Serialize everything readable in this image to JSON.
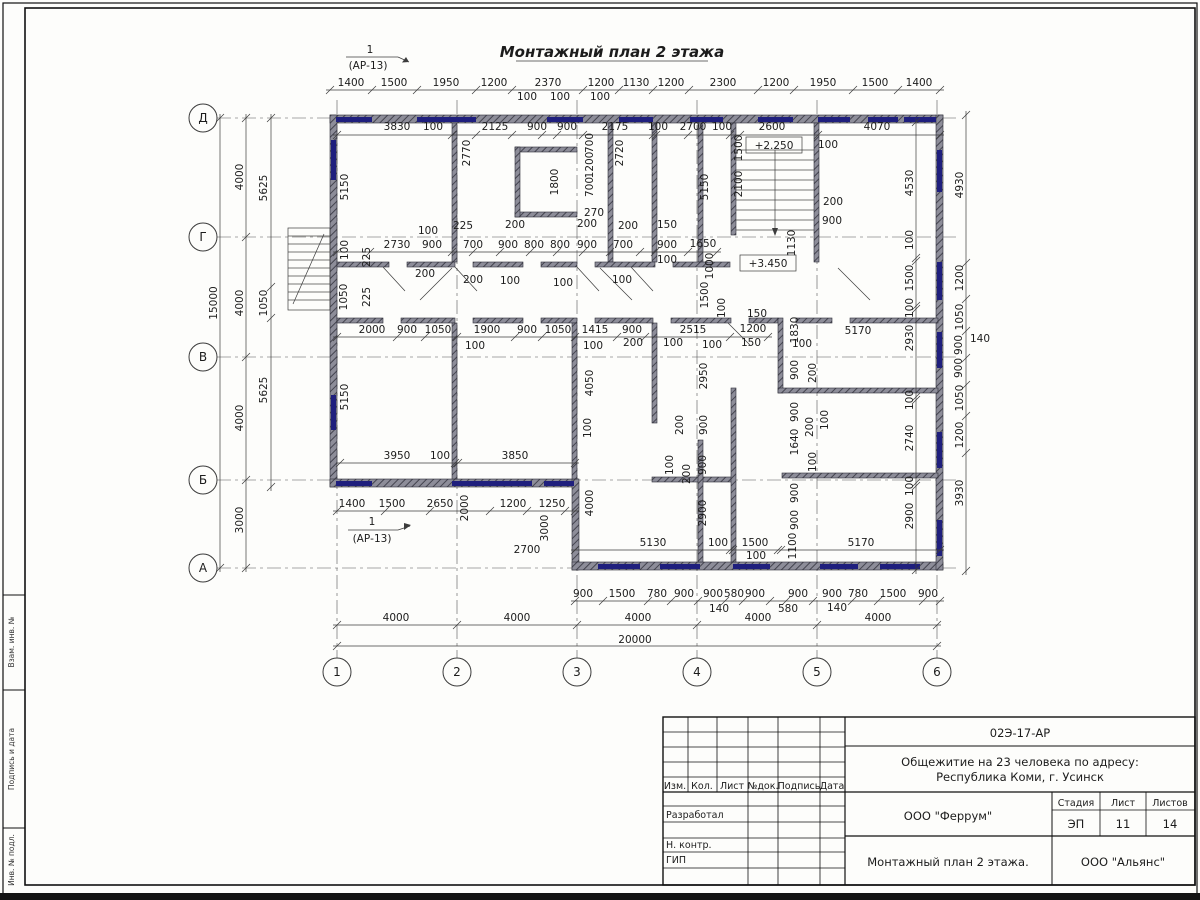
{
  "drawing": {
    "title": "Монтажный план 2 этажа",
    "section_mark": {
      "number": "1",
      "sheet_ref": "(АР-13)"
    },
    "elevation_marks": [
      "+2.250",
      "+3.450"
    ]
  },
  "axes": {
    "rows": [
      "Д",
      "Г",
      "В",
      "Б",
      "А"
    ],
    "cols": [
      "1",
      "2",
      "3",
      "4",
      "5",
      "6"
    ]
  },
  "frame_labels": [
    "Взам. инв. №",
    "Подпись и дата",
    "Инв. № подл."
  ],
  "title_block": {
    "doc_number": "02Э-17-АР",
    "project_line1": "Общежитие на 23 человека по адресу:",
    "project_line2": "Республика Коми, г. Усинск",
    "rev_columns": [
      "Изм.",
      "Кол.",
      "Лист",
      "№док.",
      "Подпись",
      "Дата"
    ],
    "role_rows": [
      "Разработал",
      "Н. контр.",
      "ГИП"
    ],
    "designer": "ООО \"Феррум\"",
    "stage_label": "Стадия",
    "stage": "ЭП",
    "sheet_label": "Лист",
    "sheet": "11",
    "sheets_label": "Листов",
    "sheets": "14",
    "drawing_title": "Монтажный план 2 этажа.",
    "contractor": "ООО \"Альянс\""
  },
  "colors": {
    "wall": "#8d8d99",
    "window": "#1f1f7d",
    "line": "#3c3c3c",
    "text": "#1c1c1c"
  },
  "annotations": [
    {
      "t": "1400",
      "x": 351,
      "y": 86
    },
    {
      "t": "1500",
      "x": 394,
      "y": 86
    },
    {
      "t": "1950",
      "x": 446,
      "y": 86
    },
    {
      "t": "1200",
      "x": 494,
      "y": 86
    },
    {
      "t": "2370",
      "x": 548,
      "y": 86
    },
    {
      "t": "1200",
      "x": 601,
      "y": 86
    },
    {
      "t": "1130",
      "x": 636,
      "y": 86
    },
    {
      "t": "1200",
      "x": 671,
      "y": 86
    },
    {
      "t": "2300",
      "x": 723,
      "y": 86
    },
    {
      "t": "1200",
      "x": 776,
      "y": 86
    },
    {
      "t": "1950",
      "x": 823,
      "y": 86
    },
    {
      "t": "1500",
      "x": 875,
      "y": 86
    },
    {
      "t": "1400",
      "x": 919,
      "y": 86
    },
    {
      "t": "100",
      "x": 527,
      "y": 100
    },
    {
      "t": "100",
      "x": 560,
      "y": 100
    },
    {
      "t": "100",
      "x": 600,
      "y": 100
    },
    {
      "t": "3830",
      "x": 397,
      "y": 130
    },
    {
      "t": "100",
      "x": 433,
      "y": 130
    },
    {
      "t": "2125",
      "x": 495,
      "y": 130
    },
    {
      "t": "900",
      "x": 537,
      "y": 130
    },
    {
      "t": "900",
      "x": 567,
      "y": 130
    },
    {
      "t": "2175",
      "x": 615,
      "y": 130
    },
    {
      "t": "100",
      "x": 658,
      "y": 130
    },
    {
      "t": "2700",
      "x": 693,
      "y": 130
    },
    {
      "t": "100",
      "x": 722,
      "y": 130
    },
    {
      "t": "2600",
      "x": 772,
      "y": 130
    },
    {
      "t": "4070",
      "x": 877,
      "y": 130
    },
    {
      "t": "100",
      "x": 828,
      "y": 148
    },
    {
      "t": "1500",
      "x": 742,
      "y": 148,
      "r": 1
    },
    {
      "t": "2100",
      "x": 742,
      "y": 184,
      "r": 1
    },
    {
      "t": "1130",
      "x": 795,
      "y": 243,
      "r": 1
    },
    {
      "t": "200",
      "x": 833,
      "y": 205
    },
    {
      "t": "900",
      "x": 832,
      "y": 224
    },
    {
      "t": "5150",
      "x": 348,
      "y": 187,
      "r": 1
    },
    {
      "t": "2770",
      "x": 470,
      "y": 153,
      "r": 1
    },
    {
      "t": "1800",
      "x": 558,
      "y": 182,
      "r": 1
    },
    {
      "t": "700",
      "x": 593,
      "y": 143,
      "r": 1
    },
    {
      "t": "1200",
      "x": 593,
      "y": 165,
      "r": 1
    },
    {
      "t": "700",
      "x": 593,
      "y": 187,
      "r": 1
    },
    {
      "t": "270",
      "x": 594,
      "y": 216
    },
    {
      "t": "2720",
      "x": 623,
      "y": 153,
      "r": 1
    },
    {
      "t": "5150",
      "x": 708,
      "y": 187,
      "r": 1
    },
    {
      "t": "2730",
      "x": 397,
      "y": 248
    },
    {
      "t": "900",
      "x": 432,
      "y": 248
    },
    {
      "t": "700",
      "x": 473,
      "y": 248
    },
    {
      "t": "900",
      "x": 508,
      "y": 248
    },
    {
      "t": "800",
      "x": 534,
      "y": 248
    },
    {
      "t": "800",
      "x": 560,
      "y": 248
    },
    {
      "t": "900",
      "x": 587,
      "y": 248
    },
    {
      "t": "700",
      "x": 623,
      "y": 248
    },
    {
      "t": "900",
      "x": 667,
      "y": 248
    },
    {
      "t": "1650",
      "x": 703,
      "y": 247
    },
    {
      "t": "100",
      "x": 428,
      "y": 234
    },
    {
      "t": "225",
      "x": 463,
      "y": 229
    },
    {
      "t": "200",
      "x": 515,
      "y": 228
    },
    {
      "t": "200",
      "x": 587,
      "y": 227
    },
    {
      "t": "200",
      "x": 628,
      "y": 229
    },
    {
      "t": "150",
      "x": 667,
      "y": 228
    },
    {
      "t": "200",
      "x": 425,
      "y": 277
    },
    {
      "t": "200",
      "x": 473,
      "y": 283
    },
    {
      "t": "100",
      "x": 510,
      "y": 284
    },
    {
      "t": "100",
      "x": 563,
      "y": 286
    },
    {
      "t": "100",
      "x": 622,
      "y": 283
    },
    {
      "t": "100",
      "x": 667,
      "y": 263
    },
    {
      "t": "100",
      "x": 348,
      "y": 250,
      "r": 1
    },
    {
      "t": "225",
      "x": 370,
      "y": 257,
      "r": 1
    },
    {
      "t": "1050",
      "x": 347,
      "y": 297,
      "r": 1
    },
    {
      "t": "225",
      "x": 370,
      "y": 297,
      "r": 1
    },
    {
      "t": "1000",
      "x": 713,
      "y": 266,
      "r": 1
    },
    {
      "t": "1500",
      "x": 708,
      "y": 295,
      "r": 1
    },
    {
      "t": "100",
      "x": 725,
      "y": 308,
      "r": 1
    },
    {
      "t": "2000",
      "x": 372,
      "y": 333
    },
    {
      "t": "900",
      "x": 407,
      "y": 333
    },
    {
      "t": "1050",
      "x": 438,
      "y": 333
    },
    {
      "t": "1900",
      "x": 487,
      "y": 333
    },
    {
      "t": "900",
      "x": 527,
      "y": 333
    },
    {
      "t": "1050",
      "x": 558,
      "y": 333
    },
    {
      "t": "1415",
      "x": 595,
      "y": 333
    },
    {
      "t": "900",
      "x": 632,
      "y": 333
    },
    {
      "t": "2515",
      "x": 693,
      "y": 333
    },
    {
      "t": "100",
      "x": 475,
      "y": 349
    },
    {
      "t": "100",
      "x": 593,
      "y": 349
    },
    {
      "t": "200",
      "x": 633,
      "y": 346
    },
    {
      "t": "100",
      "x": 673,
      "y": 346
    },
    {
      "t": "100",
      "x": 712,
      "y": 348
    },
    {
      "t": "150",
      "x": 751,
      "y": 346
    },
    {
      "t": "100",
      "x": 802,
      "y": 347
    },
    {
      "t": "150",
      "x": 757,
      "y": 317
    },
    {
      "t": "1200",
      "x": 753,
      "y": 332
    },
    {
      "t": "1830",
      "x": 798,
      "y": 330,
      "r": 1
    },
    {
      "t": "5170",
      "x": 858,
      "y": 334
    },
    {
      "t": "900",
      "x": 798,
      "y": 370,
      "r": 1
    },
    {
      "t": "200",
      "x": 816,
      "y": 373,
      "r": 1
    },
    {
      "t": "900",
      "x": 798,
      "y": 412,
      "r": 1
    },
    {
      "t": "200",
      "x": 813,
      "y": 427,
      "r": 1
    },
    {
      "t": "100",
      "x": 828,
      "y": 420,
      "r": 1
    },
    {
      "t": "1640",
      "x": 798,
      "y": 442,
      "r": 1
    },
    {
      "t": "100",
      "x": 816,
      "y": 462,
      "r": 1
    },
    {
      "t": "900",
      "x": 798,
      "y": 493,
      "r": 1
    },
    {
      "t": "900",
      "x": 798,
      "y": 520,
      "r": 1
    },
    {
      "t": "1100",
      "x": 796,
      "y": 546,
      "r": 1
    },
    {
      "t": "5150",
      "x": 348,
      "y": 397,
      "r": 1
    },
    {
      "t": "4050",
      "x": 593,
      "y": 383,
      "r": 1
    },
    {
      "t": "2950",
      "x": 707,
      "y": 376,
      "r": 1
    },
    {
      "t": "200",
      "x": 683,
      "y": 425,
      "r": 1
    },
    {
      "t": "900",
      "x": 707,
      "y": 425,
      "r": 1
    },
    {
      "t": "100",
      "x": 673,
      "y": 465,
      "r": 1
    },
    {
      "t": "200",
      "x": 690,
      "y": 474,
      "r": 1
    },
    {
      "t": "900",
      "x": 706,
      "y": 465,
      "r": 1
    },
    {
      "t": "100",
      "x": 591,
      "y": 428,
      "r": 1
    },
    {
      "t": "3950",
      "x": 397,
      "y": 459
    },
    {
      "t": "100",
      "x": 440,
      "y": 459
    },
    {
      "t": "3850",
      "x": 515,
      "y": 459
    },
    {
      "t": "1400",
      "x": 352,
      "y": 507
    },
    {
      "t": "1500",
      "x": 392,
      "y": 507
    },
    {
      "t": "2650",
      "x": 440,
      "y": 507
    },
    {
      "t": "2000",
      "x": 468,
      "y": 508,
      "r": 1
    },
    {
      "t": "1200",
      "x": 513,
      "y": 507
    },
    {
      "t": "1250",
      "x": 552,
      "y": 507
    },
    {
      "t": "3000",
      "x": 548,
      "y": 528,
      "r": 1
    },
    {
      "t": "2700",
      "x": 527,
      "y": 553
    },
    {
      "t": "4000",
      "x": 593,
      "y": 503,
      "r": 1
    },
    {
      "t": "2900",
      "x": 706,
      "y": 513,
      "r": 1
    },
    {
      "t": "5130",
      "x": 653,
      "y": 546
    },
    {
      "t": "100",
      "x": 718,
      "y": 546
    },
    {
      "t": "1500",
      "x": 755,
      "y": 546
    },
    {
      "t": "100",
      "x": 756,
      "y": 559
    },
    {
      "t": "5170",
      "x": 861,
      "y": 546
    },
    {
      "t": "4530",
      "x": 913,
      "y": 183,
      "r": 1
    },
    {
      "t": "100",
      "x": 913,
      "y": 240,
      "r": 1
    },
    {
      "t": "1500",
      "x": 913,
      "y": 278,
      "r": 1
    },
    {
      "t": "100",
      "x": 913,
      "y": 308,
      "r": 1
    },
    {
      "t": "2930",
      "x": 913,
      "y": 338,
      "r": 1
    },
    {
      "t": "100",
      "x": 913,
      "y": 400,
      "r": 1
    },
    {
      "t": "2740",
      "x": 913,
      "y": 438,
      "r": 1
    },
    {
      "t": "100",
      "x": 913,
      "y": 486,
      "r": 1
    },
    {
      "t": "2900",
      "x": 913,
      "y": 516,
      "r": 1
    },
    {
      "t": "4930",
      "x": 963,
      "y": 185,
      "r": 1
    },
    {
      "t": "1200",
      "x": 963,
      "y": 278,
      "r": 1
    },
    {
      "t": "1050",
      "x": 963,
      "y": 317,
      "r": 1
    },
    {
      "t": "900",
      "x": 962,
      "y": 345,
      "r": 1
    },
    {
      "t": "900",
      "x": 962,
      "y": 368,
      "r": 1
    },
    {
      "t": "1050",
      "x": 963,
      "y": 398,
      "r": 1
    },
    {
      "t": "1200",
      "x": 963,
      "y": 435,
      "r": 1
    },
    {
      "t": "3930",
      "x": 963,
      "y": 493,
      "r": 1
    },
    {
      "t": "140",
      "x": 980,
      "y": 342
    },
    {
      "t": "900",
      "x": 583,
      "y": 597
    },
    {
      "t": "1500",
      "x": 622,
      "y": 597
    },
    {
      "t": "780",
      "x": 657,
      "y": 597
    },
    {
      "t": "900",
      "x": 684,
      "y": 597
    },
    {
      "t": "900",
      "x": 713,
      "y": 597
    },
    {
      "t": "580",
      "x": 734,
      "y": 597
    },
    {
      "t": "900",
      "x": 755,
      "y": 597
    },
    {
      "t": "900",
      "x": 798,
      "y": 597
    },
    {
      "t": "900",
      "x": 832,
      "y": 597
    },
    {
      "t": "780",
      "x": 858,
      "y": 597
    },
    {
      "t": "1500",
      "x": 893,
      "y": 597
    },
    {
      "t": "900",
      "x": 928,
      "y": 597
    },
    {
      "t": "140",
      "x": 719,
      "y": 612
    },
    {
      "t": "580",
      "x": 788,
      "y": 612
    },
    {
      "t": "140",
      "x": 837,
      "y": 611
    },
    {
      "t": "4000",
      "x": 396,
      "y": 621
    },
    {
      "t": "4000",
      "x": 517,
      "y": 621
    },
    {
      "t": "4000",
      "x": 638,
      "y": 621
    },
    {
      "t": "4000",
      "x": 758,
      "y": 621
    },
    {
      "t": "4000",
      "x": 878,
      "y": 621
    },
    {
      "t": "20000",
      "x": 635,
      "y": 643
    },
    {
      "t": "4000",
      "x": 243,
      "y": 177,
      "r": 1
    },
    {
      "t": "5625",
      "x": 267,
      "y": 188,
      "r": 1
    },
    {
      "t": "15000",
      "x": 217,
      "y": 303,
      "r": 1
    },
    {
      "t": "4000",
      "x": 243,
      "y": 303,
      "r": 1
    },
    {
      "t": "1050",
      "x": 267,
      "y": 303,
      "r": 1
    },
    {
      "t": "5625",
      "x": 267,
      "y": 390,
      "r": 1
    },
    {
      "t": "4000",
      "x": 243,
      "y": 418,
      "r": 1
    },
    {
      "t": "3000",
      "x": 243,
      "y": 520,
      "r": 1
    }
  ]
}
